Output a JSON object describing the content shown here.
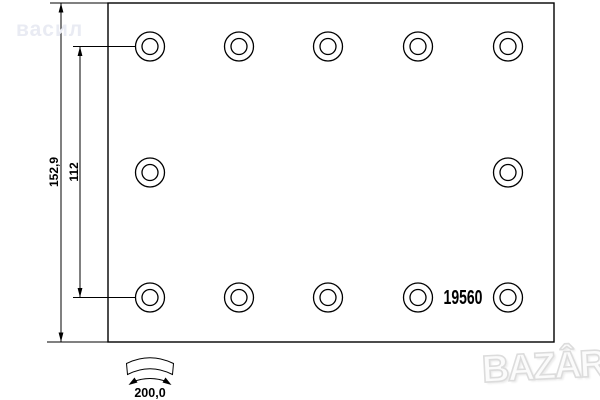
{
  "drawing": {
    "part_number": "19560",
    "dim_total_height": "152,9",
    "dim_hole_span": "112",
    "dim_arc_width": "200,0"
  },
  "watermarks": {
    "seller": "васил",
    "site": "BAZÂR"
  },
  "holes": {
    "outer_radius": 14.5,
    "inner_radius": 8,
    "positions": [
      [
        150,
        46.5
      ],
      [
        239,
        46.5
      ],
      [
        328,
        46.5
      ],
      [
        418,
        46.5
      ],
      [
        508,
        46.5
      ],
      [
        150,
        172.5
      ],
      [
        508,
        172.5
      ],
      [
        150,
        297.5
      ],
      [
        239,
        297.5
      ],
      [
        328,
        297.5
      ],
      [
        418,
        297.5
      ],
      [
        508,
        297.5
      ]
    ]
  },
  "colors": {
    "line": "#000000",
    "background": "#ffffff",
    "watermark_gray": "#e9ebf3"
  }
}
